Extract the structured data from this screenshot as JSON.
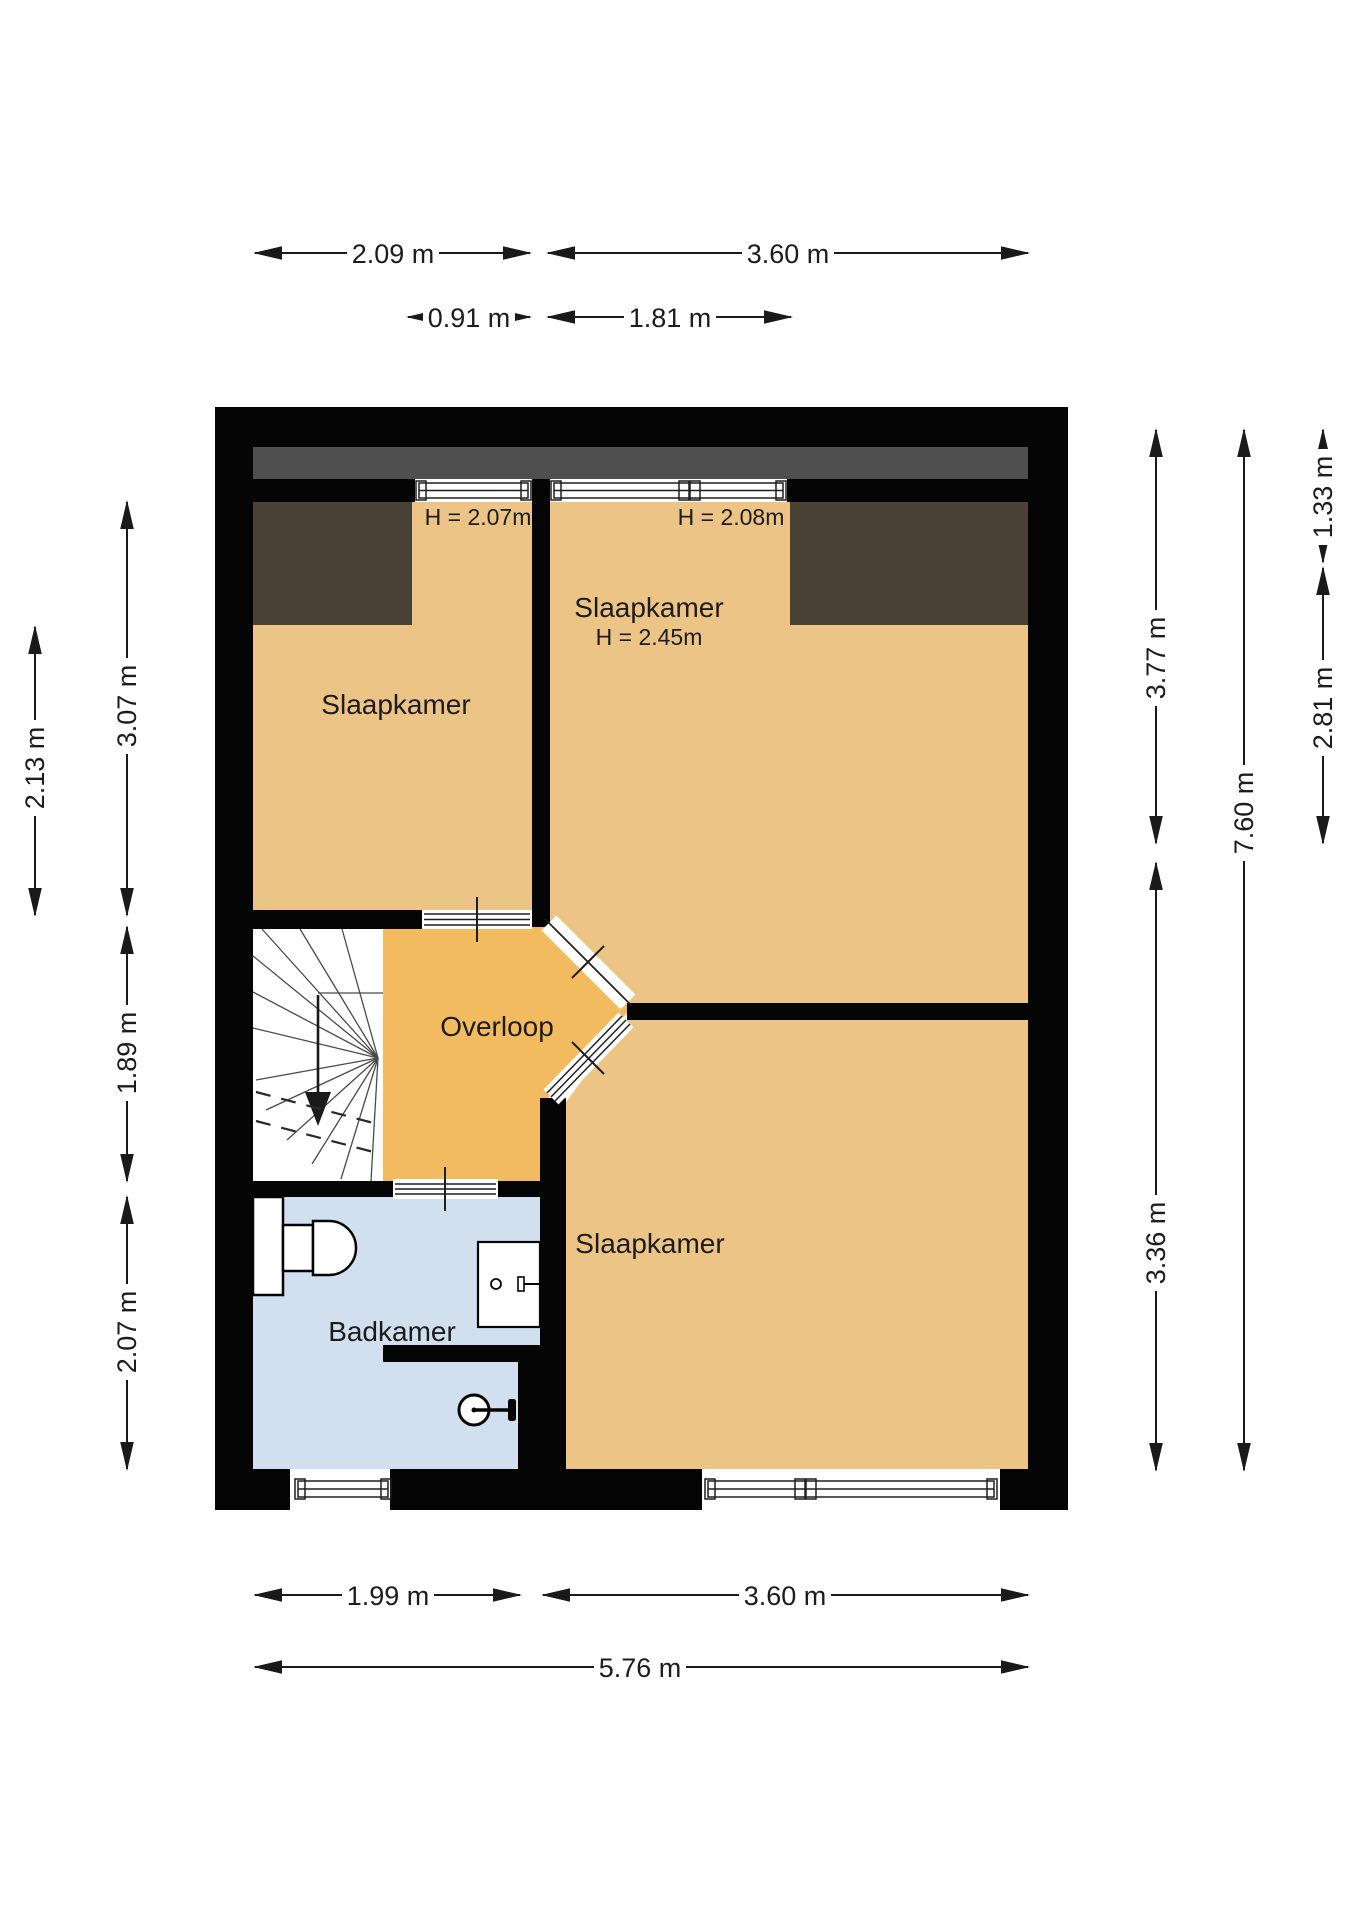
{
  "plan": {
    "title": "floor-plan-first-floor",
    "rooms": [
      {
        "id": "slaapkamer-1",
        "label": "Slaapkamer",
        "height_note": "H = 2.07m"
      },
      {
        "id": "slaapkamer-2",
        "label": "Slaapkamer",
        "height_note": "H = 2.45m",
        "window_height_note": "H = 2.08m"
      },
      {
        "id": "overloop",
        "label": "Overloop"
      },
      {
        "id": "badkamer",
        "label": "Badkamer"
      },
      {
        "id": "slaapkamer-3",
        "label": "Slaapkamer"
      }
    ],
    "dimensions": {
      "top_row1": [
        {
          "label": "2.09 m"
        },
        {
          "label": "3.60 m"
        }
      ],
      "top_row2": [
        {
          "label": "0.91 m"
        },
        {
          "label": "1.81 m"
        }
      ],
      "bottom_row1": [
        {
          "label": "1.99 m"
        },
        {
          "label": "3.60 m"
        }
      ],
      "bottom_row2": [
        {
          "label": "5.76 m"
        }
      ],
      "left": [
        {
          "label": "2.13 m"
        },
        {
          "label": "3.07 m"
        },
        {
          "label": "1.89 m"
        },
        {
          "label": "2.07 m"
        }
      ],
      "right": [
        {
          "label": "3.77 m"
        },
        {
          "label": "3.36 m"
        },
        {
          "label": "7.60 m"
        },
        {
          "label": "1.33 m"
        },
        {
          "label": "2.81 m"
        }
      ]
    },
    "colors": {
      "room_floor": "#ecc485",
      "hall_floor": "#f3bb60",
      "bath_floor": "#d2dfee",
      "low_ceiling_area": "#494135",
      "roof_edge_band": "#4f4f4f",
      "wall": "#050505"
    },
    "fixtures": [
      "stairs",
      "toilet",
      "sink",
      "shower",
      "radiator"
    ]
  }
}
